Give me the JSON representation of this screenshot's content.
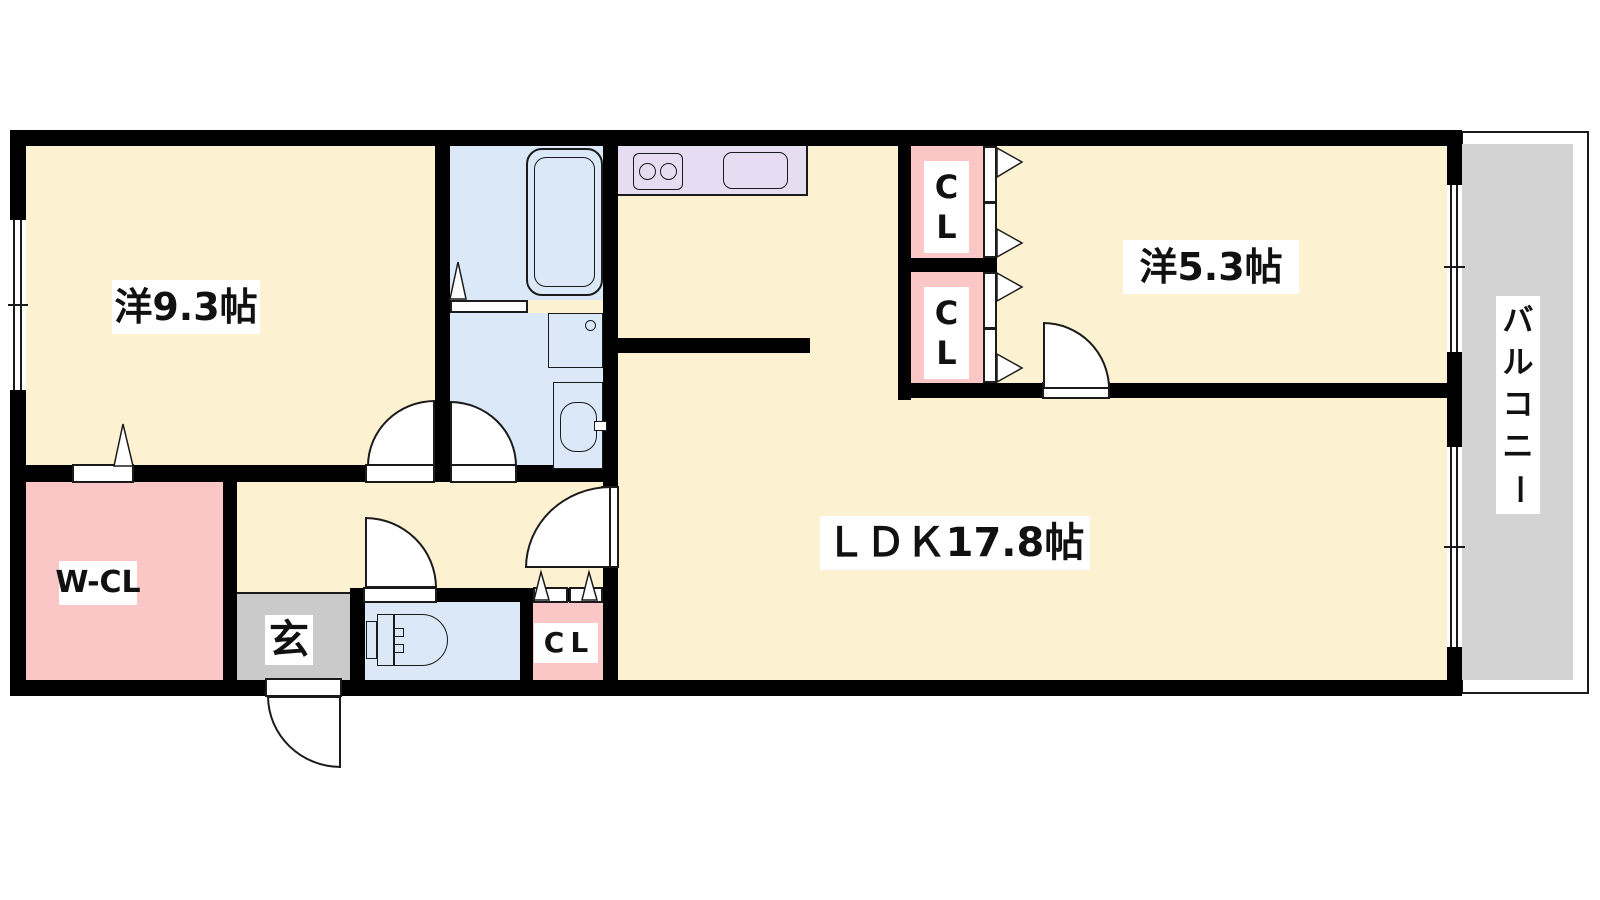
{
  "plan_title": "apartment-floor-plan",
  "labels": {
    "room_west_9_3": "洋9.3帖",
    "room_west_5_3": "洋5.3帖",
    "ldk": "ＬＤＫ17.8帖",
    "walk_in_closet": "W-CL",
    "entrance": "玄",
    "closet_hall": "CL",
    "closet_upper_c": "C",
    "closet_upper_l": "L",
    "closet_lower_c": "C",
    "closet_lower_l": "L",
    "balcony": "バルコニー"
  },
  "colors": {
    "room_cream": "#FCF1D0",
    "closet_pink": "#FBC6C6",
    "wet_area_blue": "#DAE8F8",
    "kitchen_lavender": "#E7DDF3",
    "genkan_gray": "#CACACA",
    "balcony_gray": "#D3D3D3",
    "wall": "#000000"
  }
}
